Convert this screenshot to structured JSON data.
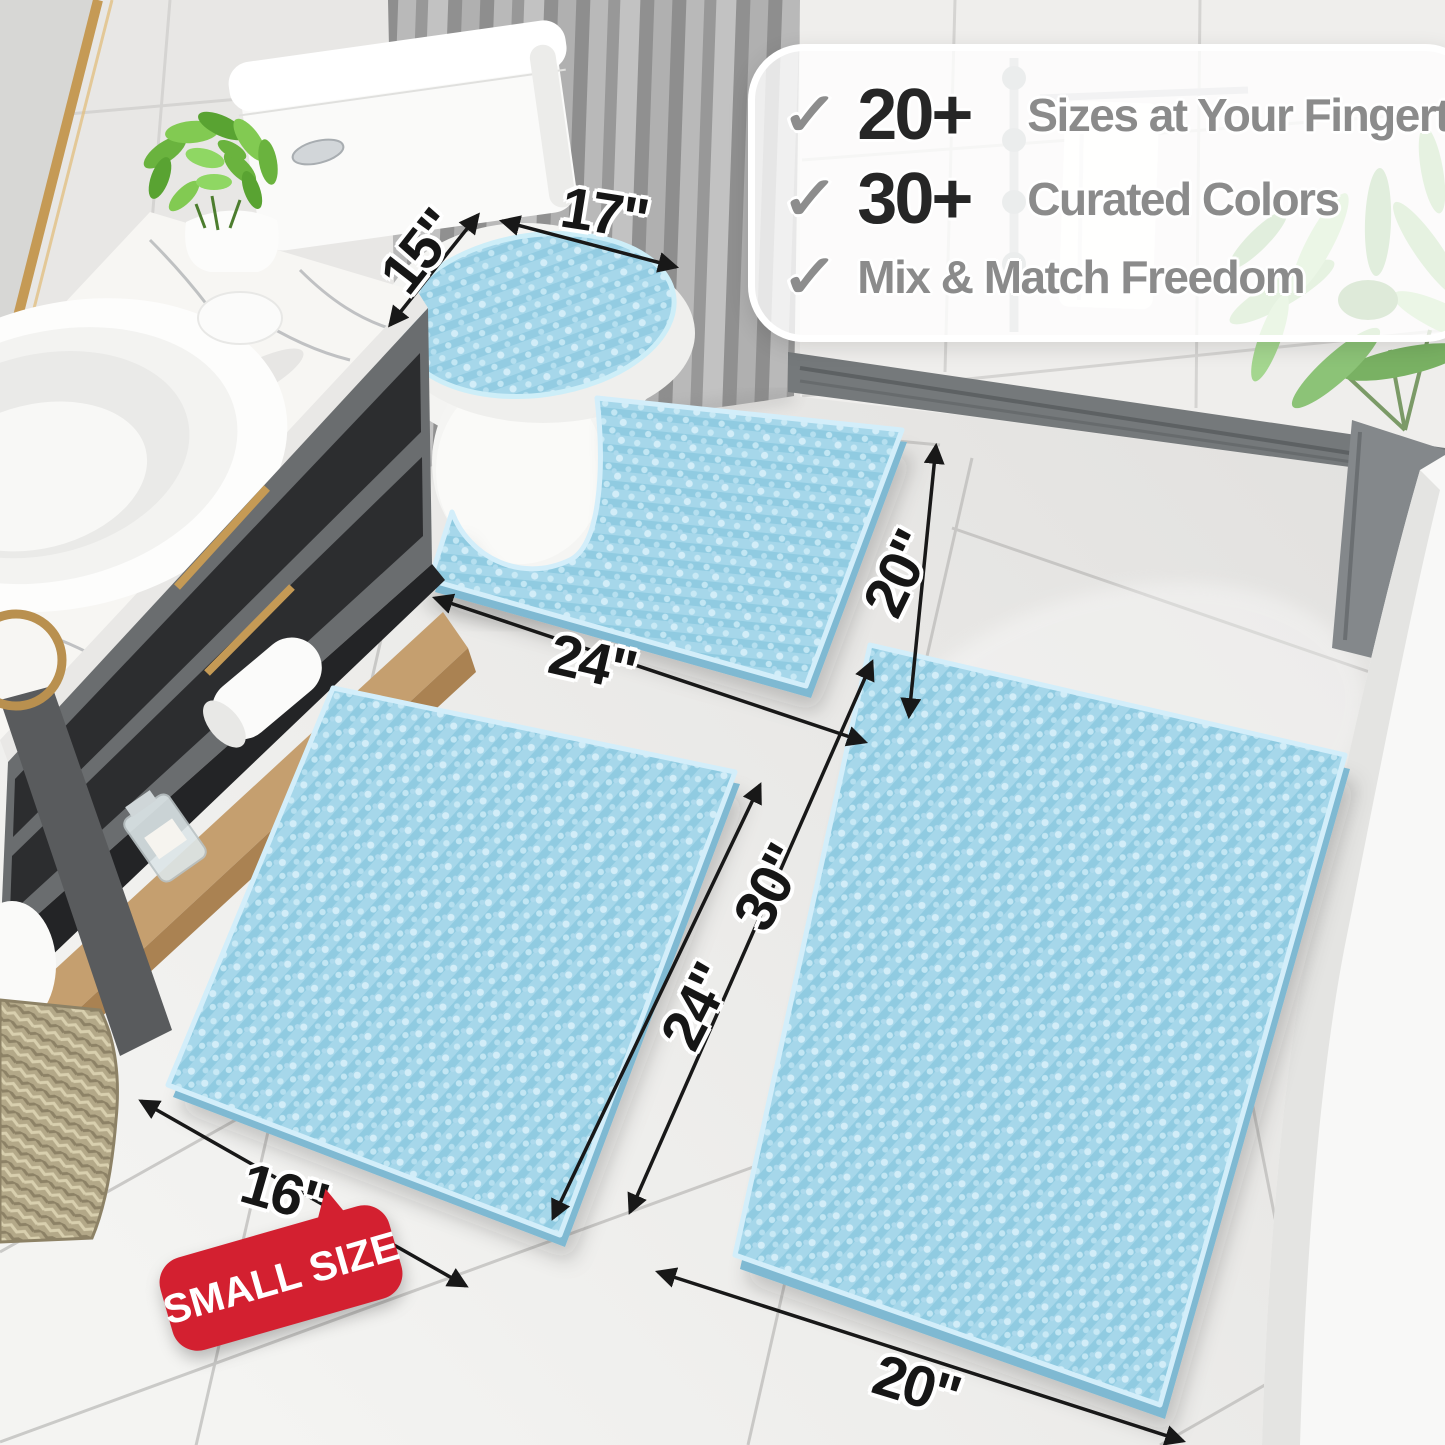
{
  "callout": {
    "check_glyph": "✓",
    "rows": [
      {
        "number": "20+",
        "label": "Sizes at Your Fingertips"
      },
      {
        "number": "30+",
        "label": "Curated Colors"
      },
      {
        "label": "Mix & Match Freedom"
      }
    ]
  },
  "badge": {
    "label": "SMALL SIZE"
  },
  "measurements": {
    "lid_cover": {
      "width": "17\"",
      "depth": "15\""
    },
    "contour_rug": {
      "width": "24\"",
      "depth": "20\""
    },
    "small_rug": {
      "width": "16\"",
      "length": "24\""
    },
    "large_rug": {
      "width": "20\"",
      "length": "30\""
    }
  },
  "colors": {
    "rug_blue": "#a6d7ea",
    "rug_blue_dark": "#90cbe1",
    "rug_blue_light": "#d2edf8",
    "badge_red": "#d32030",
    "gold_accent": "#c59a55",
    "dimension_ink": "#161616",
    "callout_gray": "#8b8b8b",
    "callout_dark": "#262626"
  }
}
